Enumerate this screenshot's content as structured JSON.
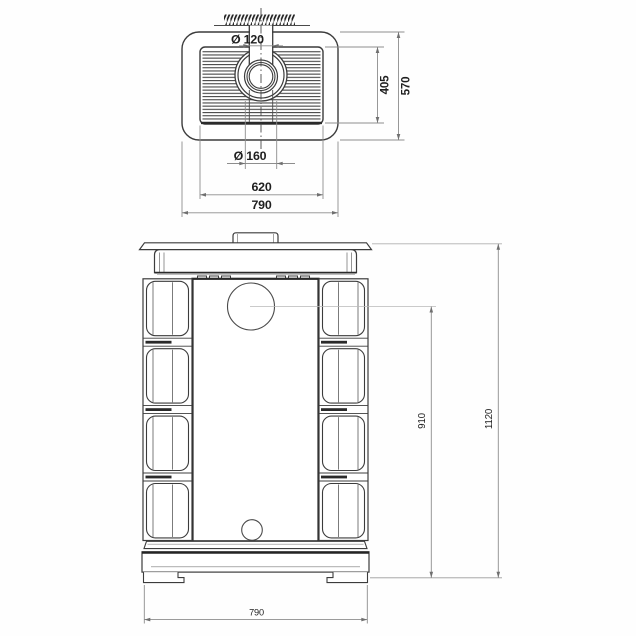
{
  "drawing": {
    "type": "technical-dimension-drawing",
    "views": {
      "top_view": {
        "dims": {
          "flue_inner_diameter": "Ø 120",
          "flue_outer_diameter": "Ø 160",
          "grille_depth": "405",
          "body_depth": "570",
          "grille_width": "620",
          "body_width": "790"
        }
      },
      "front_view": {
        "dims": {
          "flue_center_height": "910",
          "overall_height": "1120",
          "overall_width": "790"
        }
      }
    },
    "colors": {
      "background": "#fefefe",
      "object_line": "#3c3c3c",
      "thick_line": "#242424",
      "dimension_line": "#8d8d8d",
      "leader_line": "#b4b4b4",
      "arrow": "#6f6f6f",
      "text": "#1f1f1f",
      "hatch": "#222222"
    }
  }
}
